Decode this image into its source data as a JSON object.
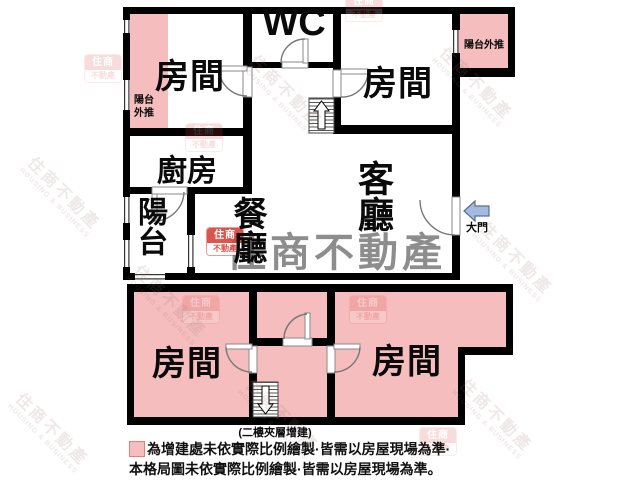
{
  "rooms": {
    "bedroom_top_left": "房間",
    "wc": "WC",
    "bedroom_top_right": "房間",
    "kitchen": "廚房",
    "balcony": "陽台",
    "dining": "餐廳",
    "living": "客廳",
    "bedroom_bottom_left": "房間",
    "bedroom_bottom_right": "房間"
  },
  "annotations": {
    "balcony_pushout_right": "陽台外推",
    "balcony_pushout_left_line1": "陽台",
    "balcony_pushout_left_line2": "外推",
    "main_door_label": "大門",
    "mezzanine_caption": "(二樓夾層增建)"
  },
  "legend": {
    "line1": "為增建處未依實際比例繪製·皆需以房屋現場為準·",
    "line2": "本格局圖未依實際比例繪製·皆需以房屋現場為準。"
  },
  "watermark": {
    "brand_text": "住商不動產",
    "brand_text_en": "HOUSING & BUSINESS",
    "logo_top": "住商",
    "logo_bottom": "不動產"
  },
  "colors": {
    "addition_pink": "#f5bdbd",
    "wall_black": "#000000",
    "entry_arrow_fill": "#a2bbdf",
    "entry_arrow_stroke": "#5b6d96",
    "watermark_gray": "#7d7d7d",
    "brand_red": "#d8433c"
  }
}
